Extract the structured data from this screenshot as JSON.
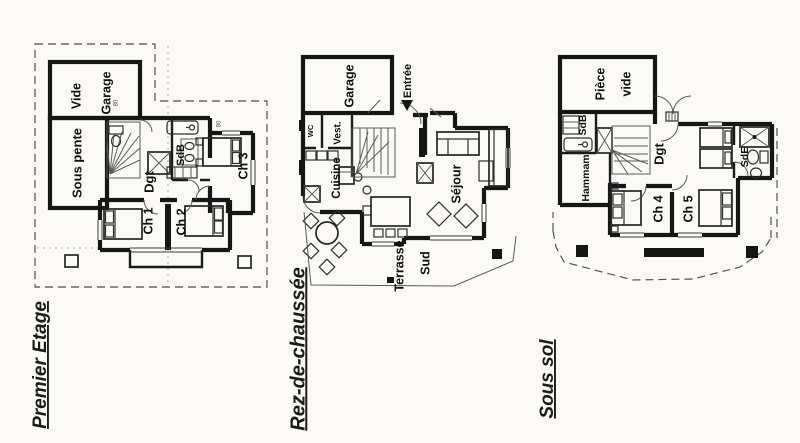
{
  "page": {
    "background": "#fbfaf7",
    "ink": "#161616",
    "pencil": "#5a5a5a"
  },
  "plans": [
    {
      "id": "premier-etage",
      "title": "Premier Etage",
      "rooms": {
        "vide": "Vide",
        "garage": "Garage",
        "sous_pente": "Sous pente",
        "sdb": "SdB",
        "dgt": "Dgt",
        "ch1": "Ch 1",
        "ch2": "Ch 2",
        "ch3": "Ch 3"
      },
      "annotations": {
        "door_width_a": "80",
        "door_width_b": "80"
      }
    },
    {
      "id": "rez-de-chaussee",
      "title": "Rez-de-chaussée",
      "rooms": {
        "garage": "Garage",
        "entree": "Entrée",
        "wc": "WC",
        "vest": "Vest.",
        "cuisine": "Cuisine",
        "sejour": "Séjour",
        "terrasse": "Terrasse",
        "sud": "Sud"
      }
    },
    {
      "id": "sous-sol",
      "title": "Sous sol",
      "rooms": {
        "piece_vide_line1": "Pièce",
        "piece_vide_line2": "vide",
        "sdb": "SdB",
        "hammam": "Hammam",
        "dgt": "Dgt",
        "ch4": "Ch 4",
        "ch5": "Ch 5",
        "sde": "SdE"
      }
    }
  ]
}
